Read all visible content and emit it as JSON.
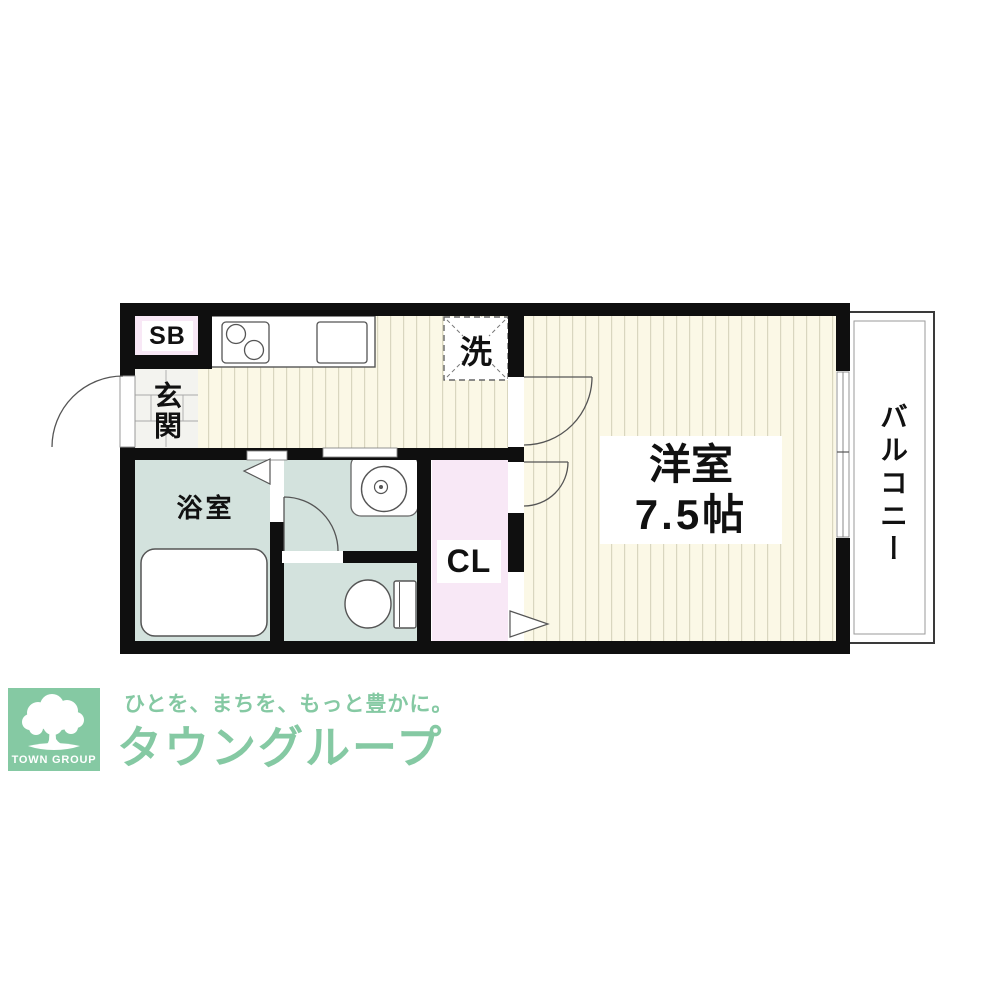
{
  "floorplan": {
    "storage_box_label": "SB",
    "entrance_label": "玄関",
    "laundry_label": "洗",
    "bathroom_label": "浴室",
    "closet_label": "CL",
    "room_label": "洋室",
    "room_size_label": "7.5帖",
    "balcony_label": "バルコニー",
    "colors": {
      "wall": "#0f0f0f",
      "flooring": "#fbf8e6",
      "flooring_stripe": "#d9d6bf",
      "wet_area": "#d3e2dd",
      "closet_pink": "#f8e8f6",
      "entrance_tile": "#f3f3ef"
    }
  },
  "footer": {
    "logo_caption": "TOWN GROUP",
    "slogan": "ひとを、まちを、もっと豊かに。",
    "brand_name": "タウングループ",
    "brand_color": "#85c9a3"
  }
}
